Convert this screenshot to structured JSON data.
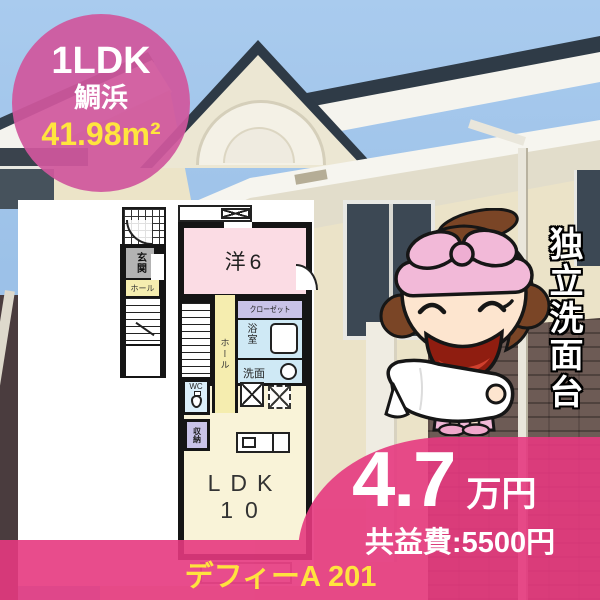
{
  "badge": {
    "layout": "1LDK",
    "location": "鯛浜",
    "area": "41.98m²"
  },
  "plan": {
    "room_main": "洋6",
    "closet": "クローゼット",
    "bath": "浴室",
    "washbasin": "洗面",
    "hall_2f": "ホール",
    "wc": "WC",
    "storage": "収納",
    "ldk": "LDK",
    "ldk_size": "10",
    "entrance": "玄関",
    "hall_1f": "ホール"
  },
  "feature": {
    "vertical_text": "独立洗面台"
  },
  "price": {
    "rent": "4.7",
    "unit": "万円",
    "common_fee": "共益費:5500円"
  },
  "property": {
    "name": "デフィーA 201"
  },
  "colors": {
    "badge_pink": "#d0579d",
    "wave_pink": "#e6397f",
    "accent_yellow": "#ffe33e"
  },
  "icons": {
    "mascot": "mascot-girl-with-towel-icon"
  }
}
